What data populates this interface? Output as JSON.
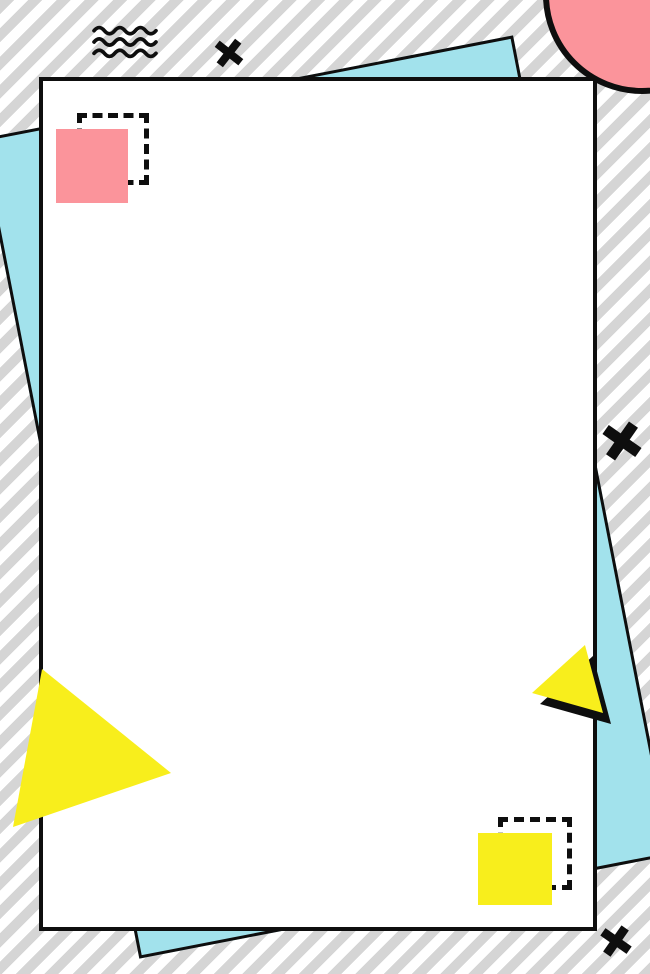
{
  "canvas": {
    "width_px": 650,
    "height_px": 974,
    "description": "Memphis-style geometric poster background with a blank white canvas sheet"
  },
  "palette": {
    "stripe_gray": "#d5d5d5",
    "white": "#ffffff",
    "cyan": "#a2e2ec",
    "pink": "#fb949b",
    "yellow": "#f8ee1c",
    "ink": "#0e0e0e"
  },
  "shapes": {
    "background": {
      "pattern": "diagonal-stripes",
      "direction": "bottom-left-to-top-right",
      "stripe_width_px": 10
    },
    "cyan_sheet": {
      "type": "rotated-rectangle",
      "rotation_deg": -11,
      "border": "solid-black"
    },
    "white_card": {
      "type": "rectangle",
      "border": "solid-black",
      "content": "blank"
    },
    "pink_circle": {
      "type": "circle",
      "position": "top-right",
      "border": "solid-black",
      "clipped": true
    },
    "pink_square": {
      "type": "square",
      "position": "top-left",
      "companion": "offset-dashed-outline"
    },
    "yellow_square": {
      "type": "square",
      "position": "bottom-right",
      "companion": "offset-dashed-outline"
    },
    "big_yellow_triangle": {
      "type": "triangle",
      "position": "bottom-left",
      "points_right": true
    },
    "small_yellow_triangle": {
      "type": "triangle",
      "position": "mid-right",
      "black_drop_shadow": true
    },
    "squiggle": {
      "type": "wave-lines",
      "count": 3,
      "position": "top-left"
    },
    "cross_marks": {
      "type": "rotated-plus",
      "count": 3,
      "positions": [
        "top",
        "mid-right",
        "bottom-right"
      ]
    }
  }
}
